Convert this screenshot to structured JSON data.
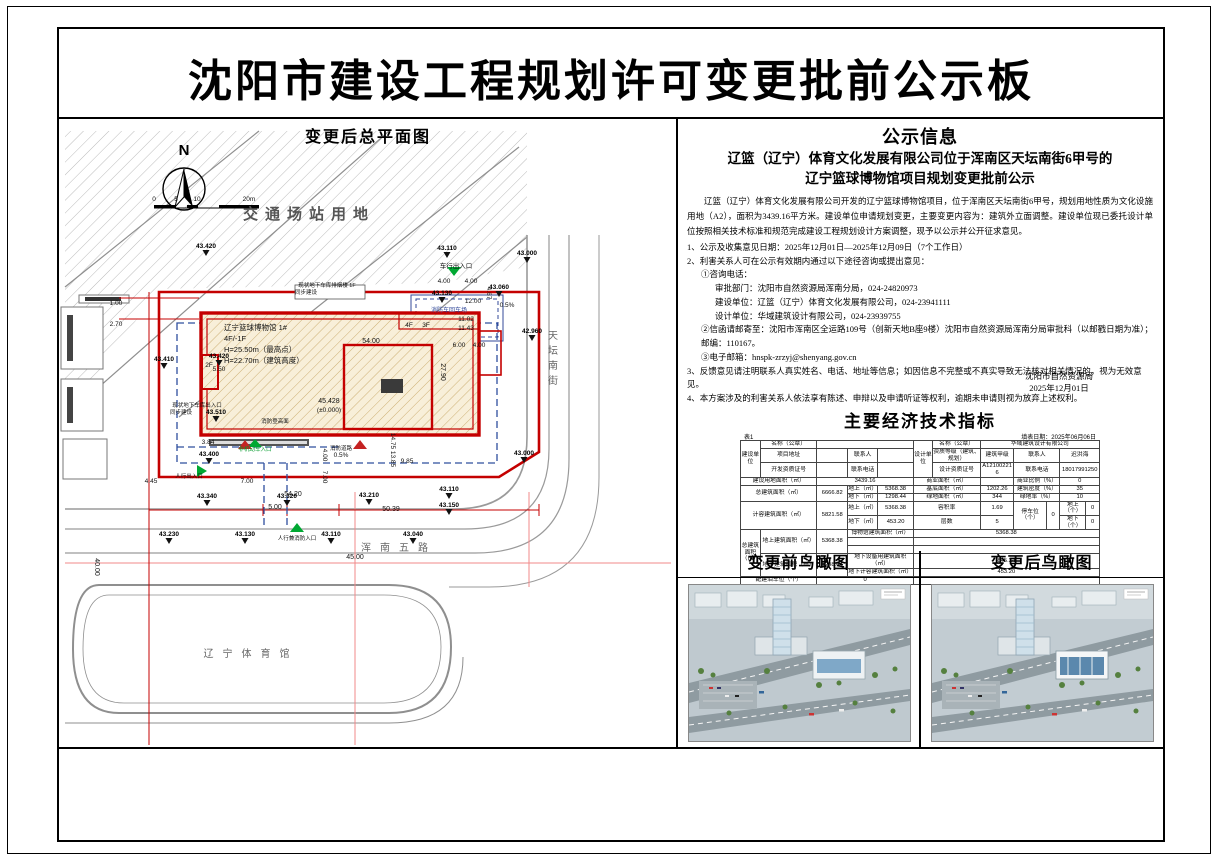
{
  "page_title": "沈阳市建设工程规划许可变更批前公示板",
  "site_plan": {
    "panel_title": "变更后总平面图",
    "labels": [
      {
        "t": "N",
        "x": 125,
        "y": 38,
        "c": "n"
      },
      {
        "t": "0",
        "x": 95,
        "y": 84,
        "c": "sm"
      },
      {
        "t": "5",
        "x": 117,
        "y": 84,
        "c": "sm"
      },
      {
        "t": "10",
        "x": 138,
        "y": 84,
        "c": "sm"
      },
      {
        "t": "20m",
        "x": 190,
        "y": 84,
        "c": "sm"
      },
      {
        "t": "交通场站用地",
        "x": 250,
        "y": 102,
        "c": "big"
      },
      {
        "t": "43.420",
        "x": 147,
        "y": 131,
        "c": "elev"
      },
      {
        "t": "43.110",
        "x": 388,
        "y": 133,
        "c": "elev"
      },
      {
        "t": "43.000",
        "x": 468,
        "y": 138,
        "c": "elev"
      },
      {
        "t": "车行出入口",
        "x": 397,
        "y": 151,
        "c": "sm"
      },
      {
        "t": "4.00",
        "x": 385,
        "y": 166,
        "c": "sm"
      },
      {
        "t": "4.00",
        "x": 412,
        "y": 166,
        "c": "sm"
      },
      {
        "t": "43.130",
        "x": 383,
        "y": 178,
        "c": "elev"
      },
      {
        "t": "12.00",
        "x": 414,
        "y": 186,
        "c": "sm"
      },
      {
        "t": "消防车回车场",
        "x": 390,
        "y": 195,
        "c": "smb"
      },
      {
        "t": "11.02",
        "x": 407,
        "y": 204,
        "c": "sm"
      },
      {
        "t": "11.43",
        "x": 407,
        "y": 213,
        "c": "sm"
      },
      {
        "t": "43.060",
        "x": 440,
        "y": 172,
        "c": "elev"
      },
      {
        "t": "42.960",
        "x": 473,
        "y": 216,
        "c": "elev"
      },
      {
        "t": "43.410",
        "x": 105,
        "y": 244,
        "c": "elev"
      },
      {
        "t": "43.420",
        "x": 160,
        "y": 241,
        "c": "elev"
      },
      {
        "t": "5.50",
        "x": 160,
        "y": 254,
        "c": "sm"
      },
      {
        "t": "1.00",
        "x": 57,
        "y": 188,
        "c": "sm"
      },
      {
        "t": "2.70",
        "x": 57,
        "y": 209,
        "c": "sm"
      },
      {
        "t": "现状地下车库排烟楼 1F",
        "x": 268,
        "y": 170,
        "c": "tiny"
      },
      {
        "t": "同步建设",
        "x": 247,
        "y": 177,
        "c": "tiny"
      },
      {
        "t": "4.67",
        "x": 428,
        "y": 176,
        "c": "sm",
        "r": 90
      },
      {
        "t": "0.5%",
        "x": 448,
        "y": 190,
        "c": "sm"
      },
      {
        "t": "辽宁篮球博物馆 1#",
        "x": 165,
        "y": 213,
        "c": "bld"
      },
      {
        "t": "4F/-1F",
        "x": 165,
        "y": 224,
        "c": "bld"
      },
      {
        "t": "H=25.50m（最高点）",
        "x": 165,
        "y": 235,
        "c": "bld"
      },
      {
        "t": "H=22.70m（建筑高度）",
        "x": 165,
        "y": 246,
        "c": "bld"
      },
      {
        "t": "2F",
        "x": 150,
        "y": 250,
        "c": "sm"
      },
      {
        "t": "54.00",
        "x": 312,
        "y": 226,
        "c": "dim"
      },
      {
        "t": "4F",
        "x": 350,
        "y": 210,
        "c": "sm"
      },
      {
        "t": "3F",
        "x": 367,
        "y": 210,
        "c": "sm"
      },
      {
        "t": "27.90",
        "x": 382,
        "y": 255,
        "c": "dim",
        "r": 90
      },
      {
        "t": "6.00",
        "x": 400,
        "y": 230,
        "c": "sm"
      },
      {
        "t": "4.00",
        "x": 420,
        "y": 230,
        "c": "sm"
      },
      {
        "t": "45.428",
        "x": 270,
        "y": 286,
        "c": "dim"
      },
      {
        "t": "(±0.000)",
        "x": 270,
        "y": 295,
        "c": "sm"
      },
      {
        "t": "消防登高面",
        "x": 216,
        "y": 306,
        "c": "tiny"
      },
      {
        "t": "消防道路",
        "x": 282,
        "y": 333,
        "c": "tiny"
      },
      {
        "t": "0.5%",
        "x": 282,
        "y": 340,
        "c": "sm"
      },
      {
        "t": "43.510",
        "x": 157,
        "y": 297,
        "c": "elev"
      },
      {
        "t": "3.84",
        "x": 149,
        "y": 327,
        "c": "sm"
      },
      {
        "t": "43.400",
        "x": 150,
        "y": 339,
        "c": "elev"
      },
      {
        "t": "非机动车入口",
        "x": 196,
        "y": 334,
        "c": "grn"
      },
      {
        "t": "现状地下车库出入口",
        "x": 138,
        "y": 290,
        "c": "tiny"
      },
      {
        "t": "同步建设",
        "x": 122,
        "y": 297,
        "c": "tiny"
      },
      {
        "t": "人行出入口",
        "x": 130,
        "y": 361,
        "c": "tiny"
      },
      {
        "t": "4.00",
        "x": 264,
        "y": 338,
        "c": "sm",
        "r": 90
      },
      {
        "t": "7.00",
        "x": 264,
        "y": 360,
        "c": "sm",
        "r": 90
      },
      {
        "t": "14.75",
        "x": 332,
        "y": 324,
        "c": "sm",
        "r": 90
      },
      {
        "t": "13.85",
        "x": 332,
        "y": 342,
        "c": "sm",
        "r": 90
      },
      {
        "t": "9.85",
        "x": 348,
        "y": 346,
        "c": "sm"
      },
      {
        "t": "43.110",
        "x": 390,
        "y": 374,
        "c": "elev"
      },
      {
        "t": "43.150",
        "x": 390,
        "y": 390,
        "c": "elev"
      },
      {
        "t": "43.000",
        "x": 465,
        "y": 338,
        "c": "elev"
      },
      {
        "t": "4.45",
        "x": 92,
        "y": 366,
        "c": "sm"
      },
      {
        "t": "7.00",
        "x": 188,
        "y": 366,
        "c": "sm"
      },
      {
        "t": "54.20",
        "x": 234,
        "y": 379,
        "c": "dim"
      },
      {
        "t": "43.210",
        "x": 310,
        "y": 380,
        "c": "elev"
      },
      {
        "t": "5.00",
        "x": 216,
        "y": 392,
        "c": "dim"
      },
      {
        "t": "50.39",
        "x": 332,
        "y": 394,
        "c": "dim"
      },
      {
        "t": "43.340",
        "x": 148,
        "y": 381,
        "c": "elev"
      },
      {
        "t": "43.320",
        "x": 228,
        "y": 381,
        "c": "elev"
      },
      {
        "t": "43.230",
        "x": 110,
        "y": 419,
        "c": "elev"
      },
      {
        "t": "43.130",
        "x": 186,
        "y": 419,
        "c": "elev"
      },
      {
        "t": "人行兼消防入口",
        "x": 238,
        "y": 423,
        "c": "tiny"
      },
      {
        "t": "43.110",
        "x": 272,
        "y": 419,
        "c": "elev"
      },
      {
        "t": "43.040",
        "x": 354,
        "y": 419,
        "c": "elev"
      },
      {
        "t": "浑南五路",
        "x": 340,
        "y": 434,
        "c": "road"
      },
      {
        "t": "40.00",
        "x": 36,
        "y": 450,
        "c": "dim",
        "r": 90
      },
      {
        "t": "45.00",
        "x": 296,
        "y": 442,
        "c": "dim"
      },
      {
        "t": "辽宁体育馆",
        "x": 192,
        "y": 540,
        "c": "road"
      },
      {
        "t": "天坛南街",
        "x": 494,
        "y": 222,
        "c": "roadv"
      }
    ]
  },
  "notice": {
    "title": "公示信息",
    "subtitle1": "辽篮（辽宁）体育文化发展有限公司位于浑南区天坛南街6甲号的",
    "subtitle2": "辽宁篮球博物馆项目规划变更批前公示",
    "paragraph": "辽篮（辽宁）体育文化发展有限公司开发的辽宁篮球博物馆项目，位于浑南区天坛南街6甲号，规划用地性质为文化设施用地（A2），面积为3439.16平方米。建设单位申请规划变更，主要变更内容为：建筑外立面调整。建设单位现已委托设计单位按照相关技术标准和规范完成建设工程规划设计方案调整，现予以公示并公开征求意见。",
    "lines": [
      {
        "t": "1、公示及收集意见日期：2025年12月01日—2025年12月09日（7个工作日）",
        "ind": 0
      },
      {
        "t": "2、利害关系人可在公示有效期内通过以下途径咨询或提出意见：",
        "ind": 0
      },
      {
        "t": "①咨询电话：",
        "ind": 1
      },
      {
        "t": "审批部门：沈阳市自然资源局浑南分局，024-24820973",
        "ind": 2
      },
      {
        "t": "建设单位：辽篮（辽宁）体育文化发展有限公司，024-23941111",
        "ind": 2
      },
      {
        "t": "设计单位：华域建筑设计有限公司，024-23939755",
        "ind": 2
      },
      {
        "t": "②信函请邮寄至：沈阳市浑南区全运路109号（创新天地B座9楼）沈阳市自然资源局浑南分局审批科（以邮戳日期为准）；邮编：110167。",
        "ind": 1
      },
      {
        "t": "③电子邮箱：hnspk-zrzyj@shenyang.gov.cn",
        "ind": 1
      },
      {
        "t": "3、反馈意见请注明联系人真实姓名、电话、地址等信息；如因信息不完整或不真实导致无法核对相关情况的，视为无效意见。",
        "ind": 0
      },
      {
        "t": "4、本方案涉及的利害关系人依法享有陈述、申辩以及申请听证等权利，逾期未申请则视为放弃上述权利。",
        "ind": 0
      }
    ],
    "sign1": "沈阳市自然资源局",
    "sign2": "2025年12月01日"
  },
  "indicators": {
    "title": "主要经济技术指标",
    "corner_left": "表1",
    "corner_right": "填表日期：2025年06月06日",
    "rows": [
      [
        {
          "t": "建设单位",
          "rs": 3
        },
        {
          "t": "名称（公章）"
        },
        {
          "t": "",
          "cs": 3
        },
        {
          "t": "设计单位",
          "rs": 3
        },
        {
          "t": "名称（公章）"
        },
        {
          "t": "华域建筑设计有限公司",
          "cs": 5
        }
      ],
      [
        {
          "t": "项目地址"
        },
        {
          "t": ""
        },
        {
          "t": "联系人"
        },
        {
          "t": ""
        },
        {
          "t": "资质等级（建筑、规划）"
        },
        {
          "t": "建筑甲级"
        },
        {
          "t": "联系人",
          "cs": 2
        },
        {
          "t": "迟洪海",
          "cs": 2
        }
      ],
      [
        {
          "t": "开发资质证号"
        },
        {
          "t": ""
        },
        {
          "t": "联系电话"
        },
        {
          "t": ""
        },
        {
          "t": "设计资质证号"
        },
        {
          "t": "A121002216"
        },
        {
          "t": "联系电话",
          "cs": 2
        },
        {
          "t": "18017991250",
          "cs": 2
        }
      ],
      [
        {
          "t": "建设用地面积（㎡）",
          "cs": 2
        },
        {
          "t": "3439.16",
          "cs": 3
        },
        {
          "t": "商业面积（㎡）",
          "cs": 2
        },
        {
          "t": ""
        },
        {
          "t": "商业比例（%）",
          "cs": 2
        },
        {
          "t": "0",
          "cs": 2
        }
      ],
      [
        {
          "t": "总建筑面积（㎡）",
          "cs": 2,
          "rs": 2
        },
        {
          "t": "6666.82",
          "rs": 2
        },
        {
          "t": "地上（㎡）"
        },
        {
          "t": "5368.38"
        },
        {
          "t": "基底面积（㎡）",
          "cs": 2
        },
        {
          "t": "1202.26"
        },
        {
          "t": "建筑密度（%）",
          "cs": 2
        },
        {
          "t": "35",
          "cs": 2
        }
      ],
      [
        {
          "t": "地下（㎡）"
        },
        {
          "t": "1298.44"
        },
        {
          "t": "绿地面积（㎡）",
          "cs": 2
        },
        {
          "t": "344"
        },
        {
          "t": "绿地率（%）",
          "cs": 2
        },
        {
          "t": "10",
          "cs": 2
        }
      ],
      [
        {
          "t": "计容建筑面积（㎡）",
          "cs": 2,
          "rs": 2
        },
        {
          "t": "5821.58",
          "rs": 2
        },
        {
          "t": "地上（㎡）"
        },
        {
          "t": "5368.38"
        },
        {
          "t": "容积率",
          "cs": 2
        },
        {
          "t": "1.69"
        },
        {
          "t": "停车位（个）",
          "rs": 2
        },
        {
          "t": "0",
          "rs": 2
        },
        {
          "t": "地上（个）"
        },
        {
          "t": "0"
        }
      ],
      [
        {
          "t": "地下（㎡）"
        },
        {
          "t": "453.20"
        },
        {
          "t": "层数",
          "cs": 2
        },
        {
          "t": "5"
        },
        {
          "t": "地下（个）"
        },
        {
          "t": "0"
        }
      ],
      [
        {
          "t": "总建筑面积（㎡）",
          "rs": 5
        },
        {
          "t": "地上建筑面积（㎡）",
          "rs": 3
        },
        {
          "t": "5368.38",
          "rs": 3
        },
        {
          "t": "博物馆建筑面积（㎡）",
          "cs": 2
        },
        {
          "t": "5368.38",
          "cs": 7
        }
      ],
      [
        {
          "t": "",
          "cs": 2
        },
        {
          "t": "",
          "cs": 7
        }
      ],
      [
        {
          "t": "",
          "cs": 2
        },
        {
          "t": "",
          "cs": 7
        }
      ],
      [
        {
          "t": "地下建筑面积（㎡）",
          "rs": 2
        },
        {
          "t": "1298.44",
          "rs": 2
        },
        {
          "t": "地下设备用建筑面积（㎡）",
          "cs": 2
        },
        {
          "t": "845.24",
          "cs": 7
        }
      ],
      [
        {
          "t": "地下计容建筑面积（㎡）",
          "cs": 2
        },
        {
          "t": "453.20",
          "cs": 7
        }
      ],
      [
        {
          "t": "配建泊车位（个）",
          "cs": 2
        },
        {
          "t": "0",
          "cs": 3
        },
        {
          "t": "",
          "cs": 7
        }
      ]
    ]
  },
  "renders": {
    "before_title": "变更前鸟瞰图",
    "after_title": "变更后鸟瞰图"
  },
  "colors": {
    "parcel_red": "#c40000",
    "underground_blue": "#2e4f9e",
    "entry_green": "#00a832",
    "road_gray": "#9a9a9a",
    "building_hatch": "#c9a96a"
  }
}
